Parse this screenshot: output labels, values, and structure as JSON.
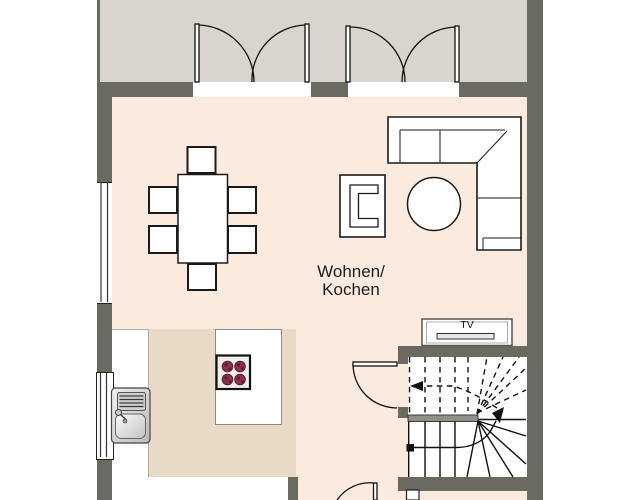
{
  "title": "Floor plan – ground floor living area",
  "room": {
    "label_line1": "Wohnen/",
    "label_line2": "Kochen"
  },
  "tv_unit": {
    "label": "TV"
  },
  "colors": {
    "wall": "#6a6a61",
    "terrace_floor": "#d9d5cc",
    "room_floor": "#fbebdf",
    "kitchen_floor": "#e9dac7",
    "furniture_outline": "#1a1a1a",
    "burner_red": "#8c3146",
    "burner_dot": "#5a1e30",
    "handrail_gray": "#90908a",
    "outside": "#ffffff"
  },
  "symbols": [
    {
      "name": "french-door-left",
      "type": "double-swing-door"
    },
    {
      "name": "french-door-right",
      "type": "double-swing-door"
    },
    {
      "name": "dining-table",
      "type": "table",
      "chairs": 6
    },
    {
      "name": "corner-sofa",
      "type": "sofa"
    },
    {
      "name": "round-coffee-table",
      "type": "table"
    },
    {
      "name": "armchair",
      "type": "chair"
    },
    {
      "name": "tv-board",
      "type": "sideboard"
    },
    {
      "name": "winder-staircase",
      "type": "stairs",
      "upper_flight": "dashed",
      "lower_flight": "solid"
    },
    {
      "name": "stair-door",
      "type": "swing-door"
    },
    {
      "name": "bottom-door",
      "type": "swing-door"
    },
    {
      "name": "kitchen-island",
      "type": "island"
    },
    {
      "name": "cooktop",
      "type": "stove",
      "burners": 4
    },
    {
      "name": "kitchen-counter",
      "type": "counter"
    },
    {
      "name": "sink",
      "type": "sink"
    },
    {
      "name": "window-upper-left",
      "type": "window"
    },
    {
      "name": "window-lower-left",
      "type": "window"
    }
  ]
}
